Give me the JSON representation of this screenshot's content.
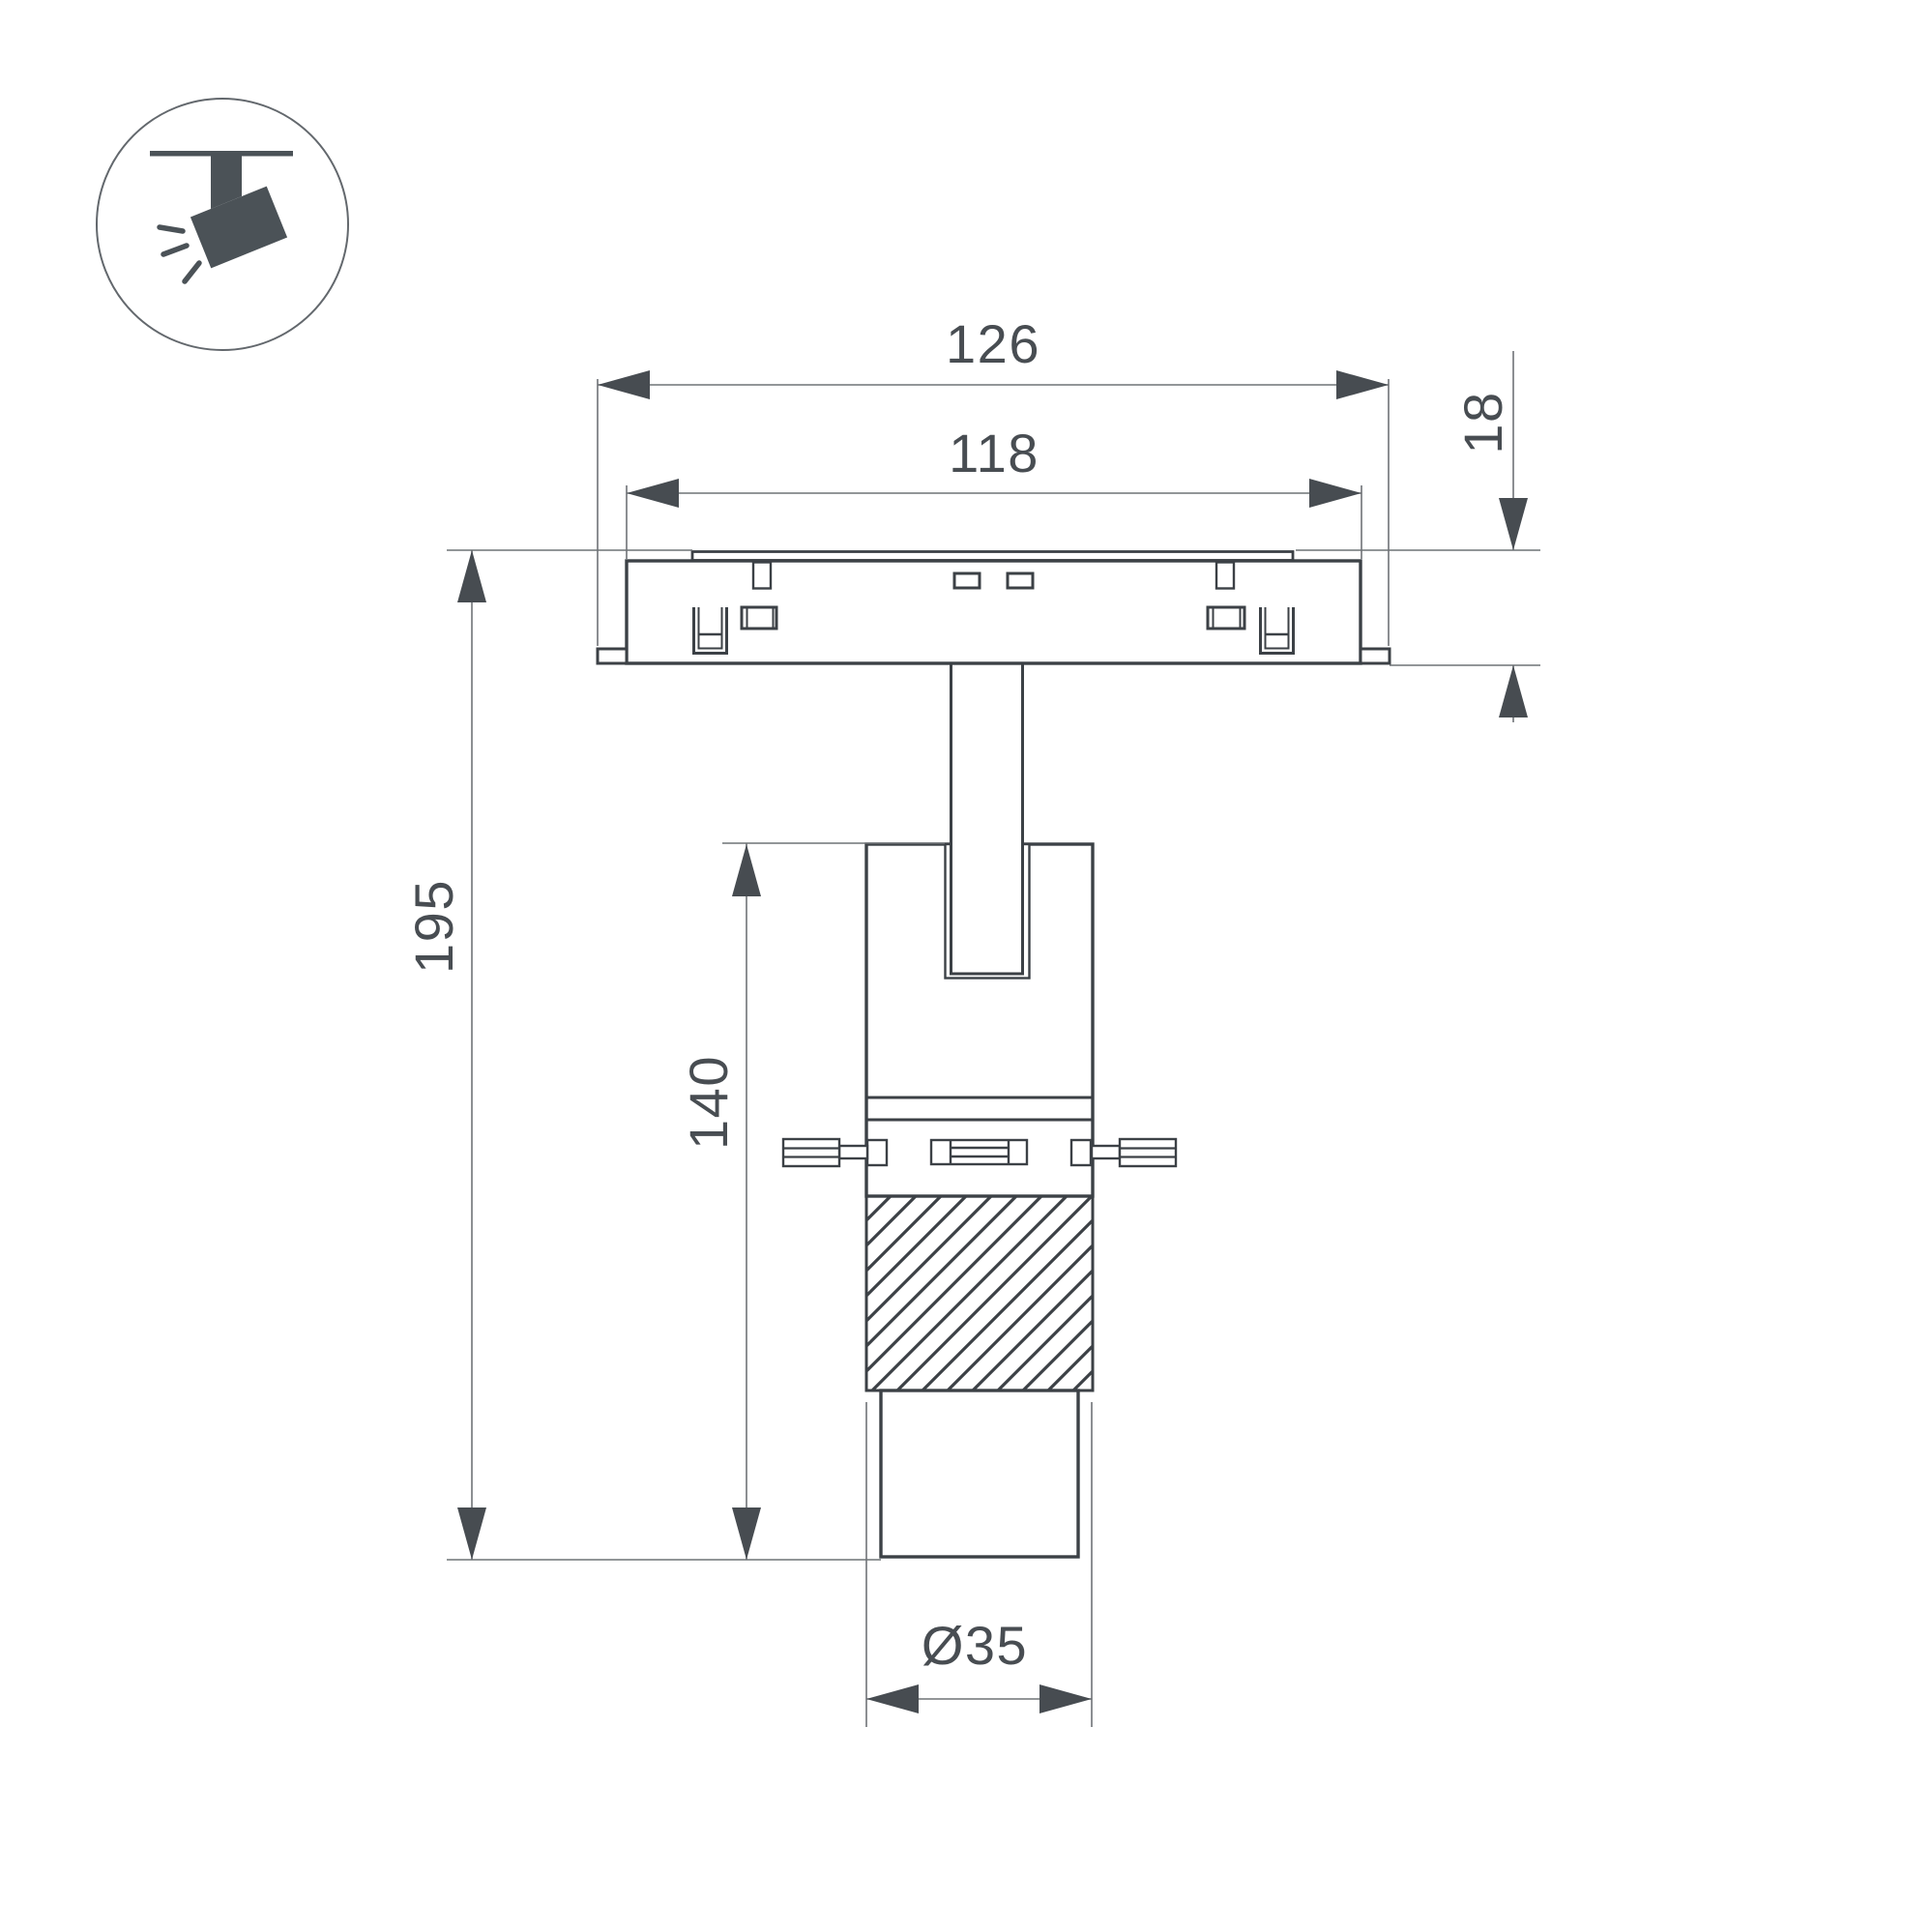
{
  "title": "track-spotlight-dimension-drawing",
  "icon": {
    "name": "ceiling-track-spotlight-pictogram"
  },
  "dimensions": {
    "overall_width": "126",
    "inner_width": "118",
    "track_height": "18",
    "total_height": "195",
    "body_height": "140",
    "diameter": "Ø35"
  },
  "colors": {
    "object_line": "#3c4146",
    "dimension_line": "#6f7377",
    "text": "#484d52",
    "icon": "#4b5257",
    "background": "#ffffff"
  }
}
